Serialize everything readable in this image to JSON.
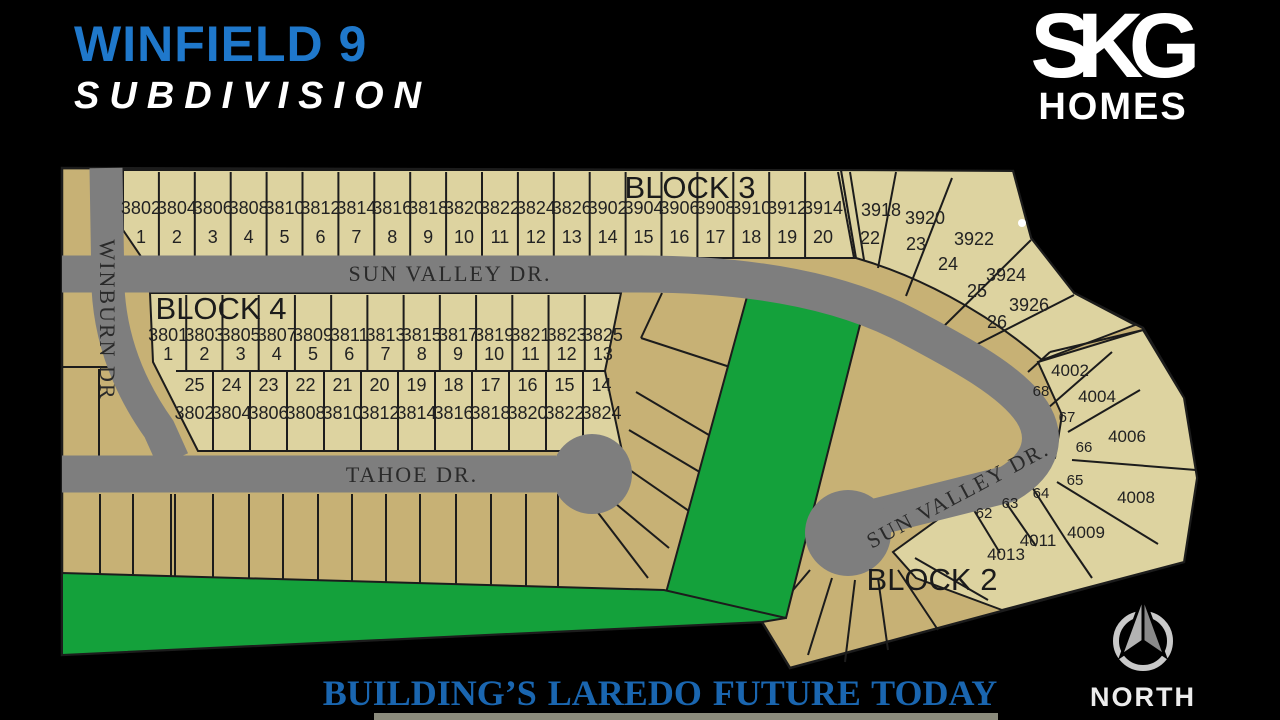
{
  "header": {
    "title_line1": "WINFIELD 9",
    "title_line2": "SUBDIVISION",
    "logo_top": "SKG",
    "logo_bottom": "HOMES"
  },
  "footer": {
    "tagline": "BUILDING’S LAREDO FUTURE TODAY",
    "compass_label": "NORTH"
  },
  "map": {
    "streets": {
      "sun_valley_top": "SUN VALLEY DR.",
      "tahoe": "TAHOE DR.",
      "winburn": "WINBURN DR",
      "sun_valley_diag": "SUN VALLEY DR."
    },
    "block3": {
      "label": "BLOCK 3",
      "lots": [
        {
          "num": "1",
          "addr": "3802"
        },
        {
          "num": "2",
          "addr": "3804"
        },
        {
          "num": "3",
          "addr": "3806"
        },
        {
          "num": "4",
          "addr": "3808"
        },
        {
          "num": "5",
          "addr": "3810"
        },
        {
          "num": "6",
          "addr": "3812"
        },
        {
          "num": "7",
          "addr": "3814"
        },
        {
          "num": "8",
          "addr": "3816"
        },
        {
          "num": "9",
          "addr": "3818"
        },
        {
          "num": "10",
          "addr": "3820"
        },
        {
          "num": "11",
          "addr": "3822"
        },
        {
          "num": "12",
          "addr": "3824"
        },
        {
          "num": "13",
          "addr": "3826"
        },
        {
          "num": "14",
          "addr": "3902"
        },
        {
          "num": "15",
          "addr": "3904"
        },
        {
          "num": "16",
          "addr": "3906"
        },
        {
          "num": "17",
          "addr": "3908"
        },
        {
          "num": "18",
          "addr": "3910"
        },
        {
          "num": "19",
          "addr": "3912"
        },
        {
          "num": "20",
          "addr": "3914"
        }
      ],
      "fan_lots": [
        {
          "num": "22",
          "addr": "3918"
        },
        {
          "num": "23",
          "addr": "3920"
        },
        {
          "num": "24",
          "addr": "3922"
        },
        {
          "num": "25",
          "addr": "3924"
        },
        {
          "num": "26",
          "addr": "3926"
        }
      ]
    },
    "block4": {
      "label": "BLOCK 4",
      "row_top": [
        {
          "num": "1",
          "addr": "3801"
        },
        {
          "num": "2",
          "addr": "3803"
        },
        {
          "num": "3",
          "addr": "3805"
        },
        {
          "num": "4",
          "addr": "3807"
        },
        {
          "num": "5",
          "addr": "3809"
        },
        {
          "num": "6",
          "addr": "3811"
        },
        {
          "num": "7",
          "addr": "3813"
        },
        {
          "num": "8",
          "addr": "3815"
        },
        {
          "num": "9",
          "addr": "3817"
        },
        {
          "num": "10",
          "addr": "3819"
        },
        {
          "num": "11",
          "addr": "3821"
        },
        {
          "num": "12",
          "addr": "3823"
        },
        {
          "num": "13",
          "addr": "3825"
        }
      ],
      "row_bottom": [
        {
          "num": "25",
          "addr": "3802"
        },
        {
          "num": "24",
          "addr": "3804"
        },
        {
          "num": "23",
          "addr": "3806"
        },
        {
          "num": "22",
          "addr": "3808"
        },
        {
          "num": "21",
          "addr": "3810"
        },
        {
          "num": "20",
          "addr": "3812"
        },
        {
          "num": "19",
          "addr": "3814"
        },
        {
          "num": "18",
          "addr": "3816"
        },
        {
          "num": "17",
          "addr": "3818"
        },
        {
          "num": "16",
          "addr": "3820"
        },
        {
          "num": "15",
          "addr": "3822"
        },
        {
          "num": "14",
          "addr": "3824"
        }
      ]
    },
    "block2": {
      "label": "BLOCK 2",
      "lot_numbers": [
        "68",
        "67",
        "66",
        "65",
        "64",
        "63",
        "62"
      ],
      "addresses": [
        "4002",
        "4004",
        "4006",
        "4008",
        "4009",
        "4011",
        "4013"
      ]
    }
  },
  "colors": {
    "pale_lot": "#ddd3a0",
    "dark_lot": "#c7b175",
    "road": "#7e7e7e",
    "green": "#14a13b",
    "outline": "#1c1c1c",
    "title_blue": "#1f78cb",
    "tagline_blue": "#1a66b0",
    "label_dark": "#222222"
  }
}
